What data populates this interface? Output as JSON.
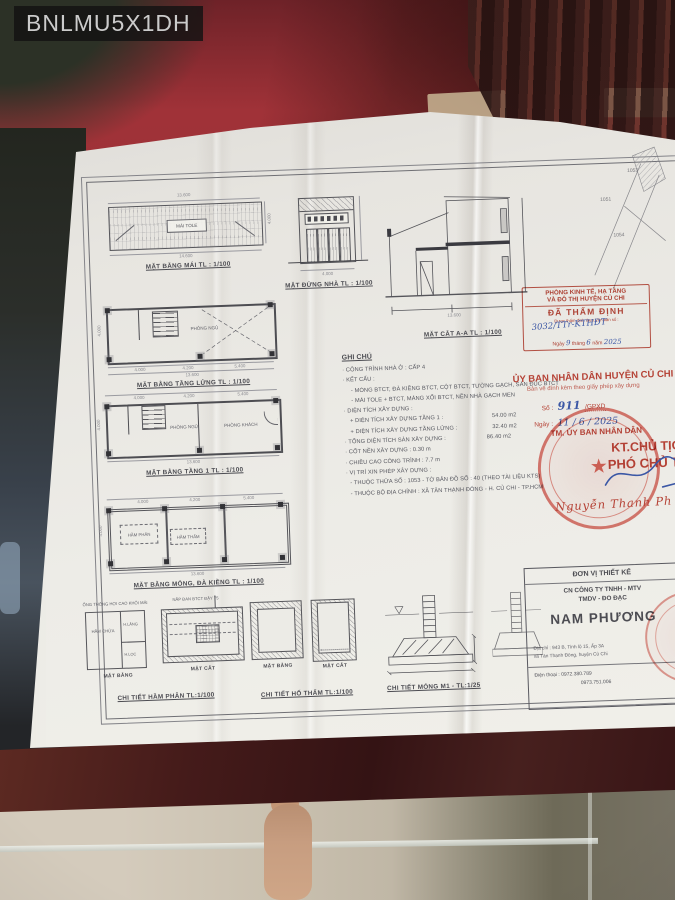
{
  "watermark": "BNLMU5X1DH",
  "colors": {
    "stamp_red": "#b5392d",
    "ink_blue": "#3b57a5",
    "paper": "#eae8e3",
    "fabric_red": "#9a2e34",
    "table_wood": "#44191a"
  },
  "sheet": {
    "common_dims": {
      "d1": "4.000",
      "d2": "4.200",
      "d3": "5.400",
      "total": "13.600",
      "side": "4.000",
      "roof_top": "13.600",
      "roof_bottom": "14.600",
      "elev_width": "4.000",
      "section_total": "13.600"
    },
    "drawings": {
      "roof_plan": {
        "title": "MẶT BẰNG MÁI TL : 1/100",
        "center_label": "MÁI TOLE"
      },
      "front_elevation": {
        "title": "MẶT ĐỨNG NHÀ TL : 1/100"
      },
      "section_aa": {
        "title": "MẶT CẮT A-A TL : 1/100"
      },
      "site_plan": {
        "parcels": [
          "1053",
          "1051",
          "1054"
        ]
      },
      "mezzanine_plan": {
        "title": "MẶT BẰNG TẦNG LỬNG TL : 1/100",
        "room": "PHÒNG NGỦ"
      },
      "floor1_plan": {
        "title": "MẶT BẰNG TẦNG 1 TL : 1/100",
        "rooms": [
          "PHÒNG NGỦ",
          "PHÒNG KHÁCH"
        ]
      },
      "foundation_plan": {
        "title": "MẶT BẰNG MÓNG, ĐÀ KIỀNG TL : 1/100",
        "labels": [
          "HẦM PHÂN",
          "HẦM THẤM"
        ]
      },
      "septic_detail": {
        "title": "CHI TIẾT HẦM PHÂN  TL:1/100",
        "view_plan": "MẶT BẰNG",
        "view_section": "MẶT CẮT",
        "room": "HẦM CHỨA",
        "cells": [
          "H.LẮNG",
          "H.LỌC"
        ],
        "note_vent": "ỐNG THÔNG HƠI CAO KHỎI MÁI",
        "note_lid": "NẮP ĐAN BTCT ĐẬY 75"
      },
      "soak_pit_detail": {
        "title": "CHI TIẾT HỐ THẤM  TL:1/100",
        "view_plan": "MẶT BẰNG",
        "view_section": "MẶT CẮT"
      },
      "footing_detail": {
        "title": "CHI TIẾT MÓNG M1 - TL:1/25"
      }
    },
    "notes": {
      "heading": "GHI CHÚ",
      "items": [
        {
          "text": "· CÔNG TRÌNH NHÀ Ở : CẤP 4"
        },
        {
          "text": "· KẾT CẤU :"
        },
        {
          "text": "- MÓNG BTCT, ĐÀ KIỀNG BTCT, CỘT BTCT, TƯỜNG GẠCH, SÀN ĐÚC BTCT"
        },
        {
          "text": "- MÁI TOLE + BTCT, MÁNG XỐI BTCT, NỀN NHÀ GẠCH MEN"
        },
        {
          "text": "· DIỆN TÍCH XÂY DỰNG :"
        },
        {
          "text": "+ DIỆN TÍCH XÂY DỰNG TẦNG 1 :",
          "value": "54.00 m2"
        },
        {
          "text": "+ DIỆN TÍCH XÂY DỰNG TẦNG LỬNG :",
          "value": "32.40 m2"
        },
        {
          "text": "· TỔNG DIỆN TÍCH SÀN XÂY DỰNG :",
          "value": "86.40 m2"
        },
        {
          "text": "· CỐT NỀN XÂY DỰNG : 0.30 m"
        },
        {
          "text": "· CHIỀU CAO CÔNG TRÌNH : 7.7 m"
        },
        {
          "text": "· VỊ TRÍ XIN PHÉP XÂY DỰNG :"
        },
        {
          "text": "- THUỘC THỬA SỐ : 1053 - TỜ BẢN ĐỒ SỐ : 40 (THEO TÀI LIỆU KTS)"
        },
        {
          "text": "- THUỘC BỘ ĐỊA CHÍNH : XÃ TÂN THẠNH ĐÔNG - H. CỦ CHI - TP.HCM"
        }
      ]
    },
    "appraisal_stamp": {
      "dept_line1": "PHÒNG KINH TẾ, HẠ TẦNG",
      "dept_line2": "VÀ ĐÔ THỊ HUYỆN CỦ CHI",
      "status": "ĐÃ THẨM ĐỊNH",
      "doc_label": "Được thẩm định theo Văn bản số :",
      "doc_number": "3032/TTr-KTHĐT",
      "date_word1": "Ngày",
      "date_day": "9",
      "date_word2": "tháng",
      "date_month": "6",
      "date_word3": "năm",
      "date_year": "2025"
    },
    "approval_stamp": {
      "authority": "ỦY BAN NHÂN DÂN HUYỆN CỦ CHI",
      "subtitle": "Bản vẽ đính kèm theo giấy phép xây dựng",
      "number_label": "Số :",
      "number": "911",
      "number_suffix": "/GPXD",
      "date_label": "Ngày :",
      "date_value": "11 / 6 / 2025",
      "tm_line": "TM. ỦY BAN NHÂN DÂN",
      "kt_line": "KT.CHỦ TỊCH",
      "deputy_line": "PHÓ CHỦ TỊCH",
      "signer": "Nguyễn Thanh Ph"
    },
    "title_block": {
      "header": "ĐƠN VỊ THIẾT KẾ",
      "company_line1": "CN CÔNG TY TNHH - MTV",
      "company_line2": "TMDV - ĐO ĐẠC",
      "brand": "NAM PHƯƠNG",
      "address_line1": "Địa chỉ : 943 B, Tỉnh lộ 15, Ấp 3A",
      "address_line2": "xã Tân Thạnh Đông, huyện Củ Chi",
      "phone_label": "Điện thoại :",
      "phone1": "0972.380.789",
      "phone2": "0973.751.006"
    }
  }
}
